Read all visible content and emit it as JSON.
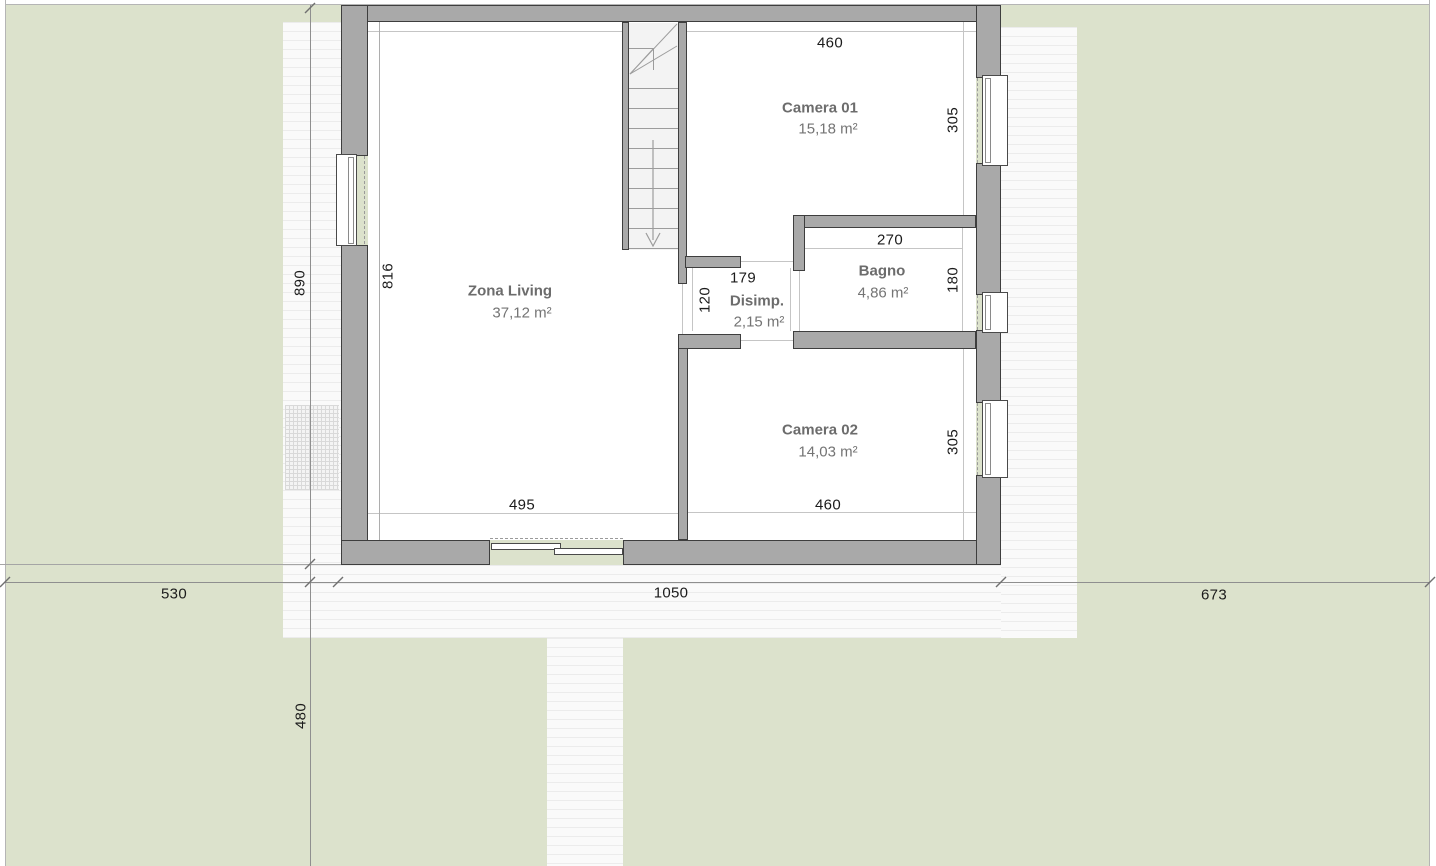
{
  "plan": {
    "rooms": [
      {
        "id": "zona-living",
        "name": "Zona Living",
        "area": "37,12 m²"
      },
      {
        "id": "camera-01",
        "name": "Camera 01",
        "area": "15,18 m²"
      },
      {
        "id": "bagno",
        "name": "Bagno",
        "area": "4,86 m²"
      },
      {
        "id": "disimp",
        "name": "Disimp.",
        "area": "2,15 m²"
      },
      {
        "id": "camera-02",
        "name": "Camera 02",
        "area": "14,03 m²"
      }
    ],
    "interior_dimensions": {
      "camera01_width": "460",
      "camera01_depth": "305",
      "bagno_width": "270",
      "bagno_depth": "180",
      "disimp_width": "179",
      "disimp_depth": "120",
      "living_depth": "816",
      "living_width": "495",
      "camera02_width": "460",
      "camera02_depth": "305"
    },
    "site_dimensions": {
      "left_of_house": "530",
      "house_width": "1050",
      "right_of_house": "673",
      "house_height": "890",
      "below_terrace": "480"
    },
    "colors": {
      "grass": "#dce2cc",
      "paving": "#fafafa",
      "wall_fill": "#a9a9a9",
      "wall_outline": "#3e3e3e",
      "floor": "#ffffff",
      "dimension_text": "#1b1b1b",
      "room_text": "#6c6c6c"
    }
  }
}
